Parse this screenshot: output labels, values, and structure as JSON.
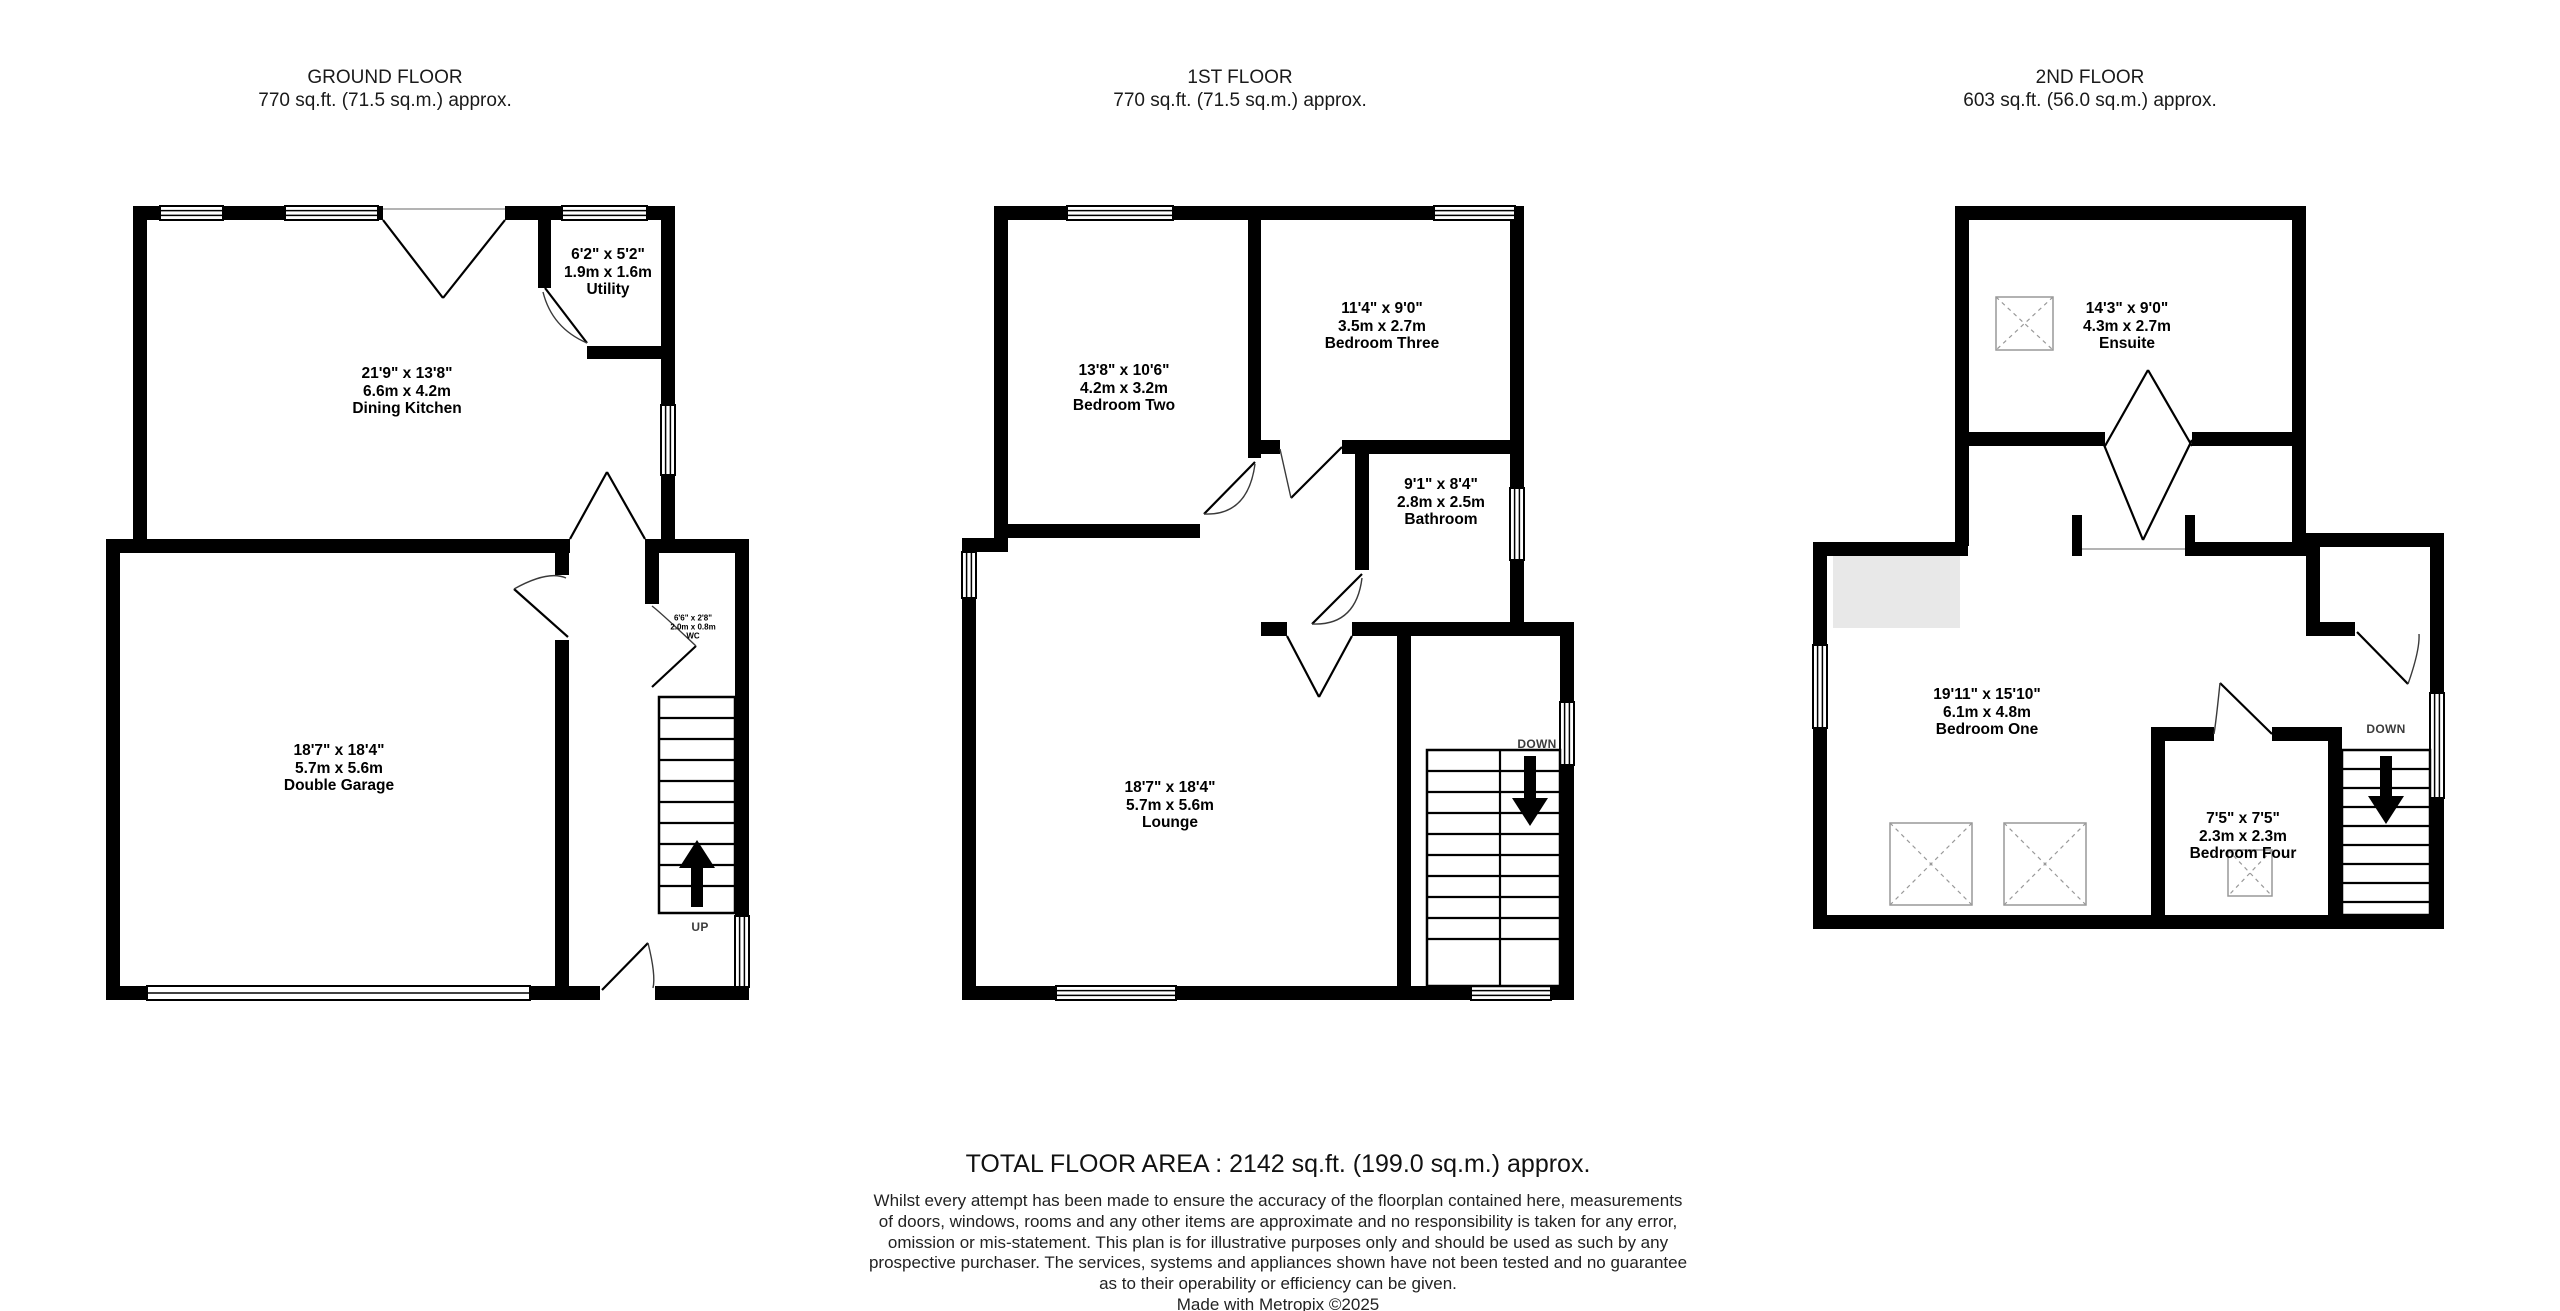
{
  "colors": {
    "wall": "#000000",
    "reduced_headroom_area": "#e8e8e8",
    "skylight_outline": "#999999",
    "text": "#1a1a1a"
  },
  "floors": [
    {
      "title": "GROUND FLOOR",
      "area": "770 sq.ft. (71.5 sq.m.) approx.",
      "stair_label": "UP",
      "rooms": {
        "utility": {
          "dim_ft": "6'2\" x 5'2\"",
          "dim_m": "1.9m x 1.6m",
          "name": "Utility"
        },
        "dining": {
          "dim_ft": "21'9\" x 13'8\"",
          "dim_m": "6.6m x 4.2m",
          "name": "Dining Kitchen"
        },
        "wc": {
          "dim_ft": "6'6\" x 2'8\"",
          "dim_m": "2.0m x 0.8m",
          "name": "WC"
        },
        "garage": {
          "dim_ft": "18'7\" x 18'4\"",
          "dim_m": "5.7m x 5.6m",
          "name": "Double Garage"
        }
      }
    },
    {
      "title": "1ST FLOOR",
      "area": "770 sq.ft. (71.5 sq.m.) approx.",
      "stair_label": "DOWN",
      "rooms": {
        "bedroom_two": {
          "dim_ft": "13'8\" x 10'6\"",
          "dim_m": "4.2m x 3.2m",
          "name": "Bedroom Two"
        },
        "bedroom_three": {
          "dim_ft": "11'4\" x 9'0\"",
          "dim_m": "3.5m x 2.7m",
          "name": "Bedroom Three"
        },
        "bathroom": {
          "dim_ft": "9'1\" x 8'4\"",
          "dim_m": "2.8m x 2.5m",
          "name": "Bathroom"
        },
        "lounge": {
          "dim_ft": "18'7\" x 18'4\"",
          "dim_m": "5.7m x 5.6m",
          "name": "Lounge"
        }
      }
    },
    {
      "title": "2ND FLOOR",
      "area": "603 sq.ft. (56.0 sq.m.) approx.",
      "stair_label": "DOWN",
      "rooms": {
        "ensuite": {
          "dim_ft": "14'3\" x 9'0\"",
          "dim_m": "4.3m x 2.7m",
          "name": "Ensuite"
        },
        "bedroom_one": {
          "dim_ft": "19'11\" x 15'10\"",
          "dim_m": "6.1m x 4.8m",
          "name": "Bedroom One"
        },
        "bedroom_four": {
          "dim_ft": "7'5\" x 7'5\"",
          "dim_m": "2.3m x 2.3m",
          "name": "Bedroom Four"
        }
      }
    }
  ],
  "footer": {
    "total": "TOTAL FLOOR AREA : 2142 sq.ft. (199.0 sq.m.) approx.",
    "disclaimer_lines": [
      "Whilst every attempt has been made to ensure the accuracy of the floorplan contained here, measurements",
      "of doors, windows, rooms and any other items are approximate and no responsibility is taken for any error,",
      "omission or mis-statement. This plan is for illustrative purposes only and should be used as such by any",
      "prospective purchaser. The services, systems and appliances shown have not been tested and no guarantee",
      "as to their operability or efficiency can be given."
    ],
    "credit": "Made with Metropix ©2025"
  }
}
